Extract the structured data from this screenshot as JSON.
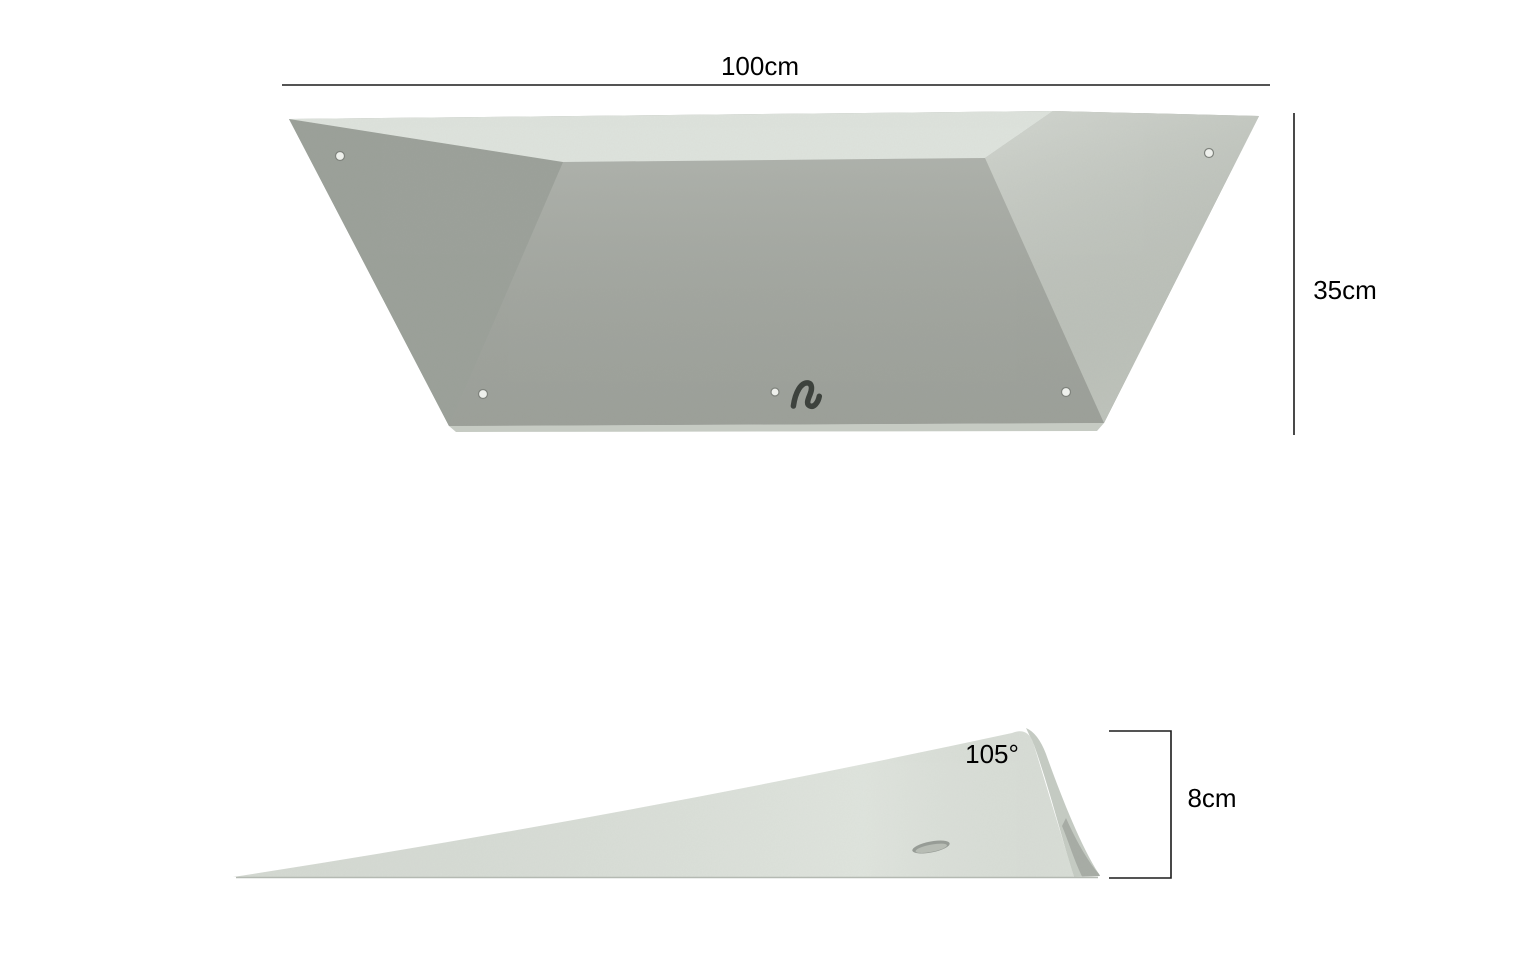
{
  "page": {
    "background_color": "#ffffff"
  },
  "product_views": {
    "top_view": {
      "width_label": "100cm",
      "height_label": "35cm"
    },
    "side_view": {
      "angle_label": "105°",
      "depth_label": "8cm"
    }
  },
  "colors": {
    "dimension_line": "#1c1c1c",
    "label_text": "#000000",
    "top_face": "#dee3dd",
    "front_face": "#a5a9a2",
    "left_face": "#9ca19a",
    "right_face": "#c8cdc5",
    "bottom_edge_strip": "#c6cbc3",
    "side_main_face": "#dde2db",
    "side_end_face": "#c6ccc4",
    "side_end_shadow": "#a8ada6",
    "side_bottom_line": "#b4b9b2",
    "logo": "#3d423d",
    "screw_hole_fill": "#eef0ec",
    "screw_hole_ring": "#7f837d",
    "bolt_hole_outer": "#979c96",
    "bolt_hole_inner": "#b7bcb4"
  },
  "icons": {
    "logo_glyph": "cursive-squiggle-brand-logo"
  }
}
